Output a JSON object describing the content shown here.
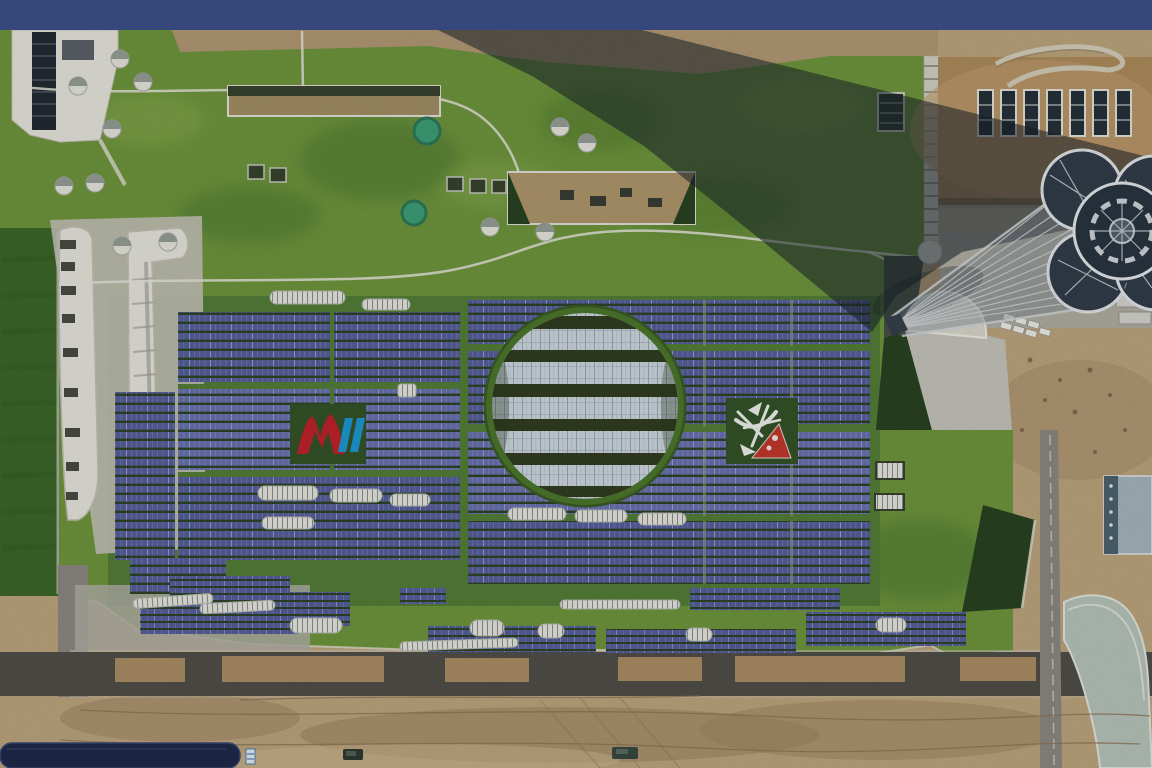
{
  "scene": {
    "type": "aerial-photograph",
    "labels": {
      "letterbox": "letterbox-bar",
      "campus": "green-roof-campus",
      "solar": "rooftop-solar-array",
      "dome": "central-circular-skylight",
      "tower": "observation-tower",
      "logo_left": "red-peaks-blue-slashes-logo",
      "logo_right": "white-bird-red-triangle-logo"
    }
  },
  "palette": {
    "letterbox": "#36477C",
    "dirtBase": "#C2A981",
    "dirtDark": "#A08763",
    "dirtLight": "#D4BE96",
    "grass": "#719A3F",
    "grassLight": "#8FB254",
    "grassDark": "#47722E",
    "grassWest": "#3E6A2B",
    "grassApron": "#55813A",
    "gapGreen": "#2F4526",
    "panel": "#59619F",
    "panelLight": "#6B74B4",
    "panelLine": "#9BA2CF",
    "glass": "#D3DDE5",
    "glassLine": "#8FA0AC",
    "white": "#ECEBE3",
    "whiteShade": "#C9C7BB",
    "tanRoof": "#B3905F",
    "shadow": "#18222B",
    "towerDark": "#333F4B",
    "lattice": "#D5DADE",
    "plaza": "#C9C9C0",
    "concrete": "#B4B3A8",
    "road": "#53514B",
    "roadLight": "#8F8D84",
    "medianTan": "#B9996B",
    "domeRim": "#4E7A2E",
    "domeDark": "#333F22",
    "navyStrip": "#202A4B",
    "logoRed": "#C4232B",
    "logoBlue": "#1E9CD7",
    "tankTeal": "#3FA37A",
    "slopeDark": "#2B4423"
  }
}
